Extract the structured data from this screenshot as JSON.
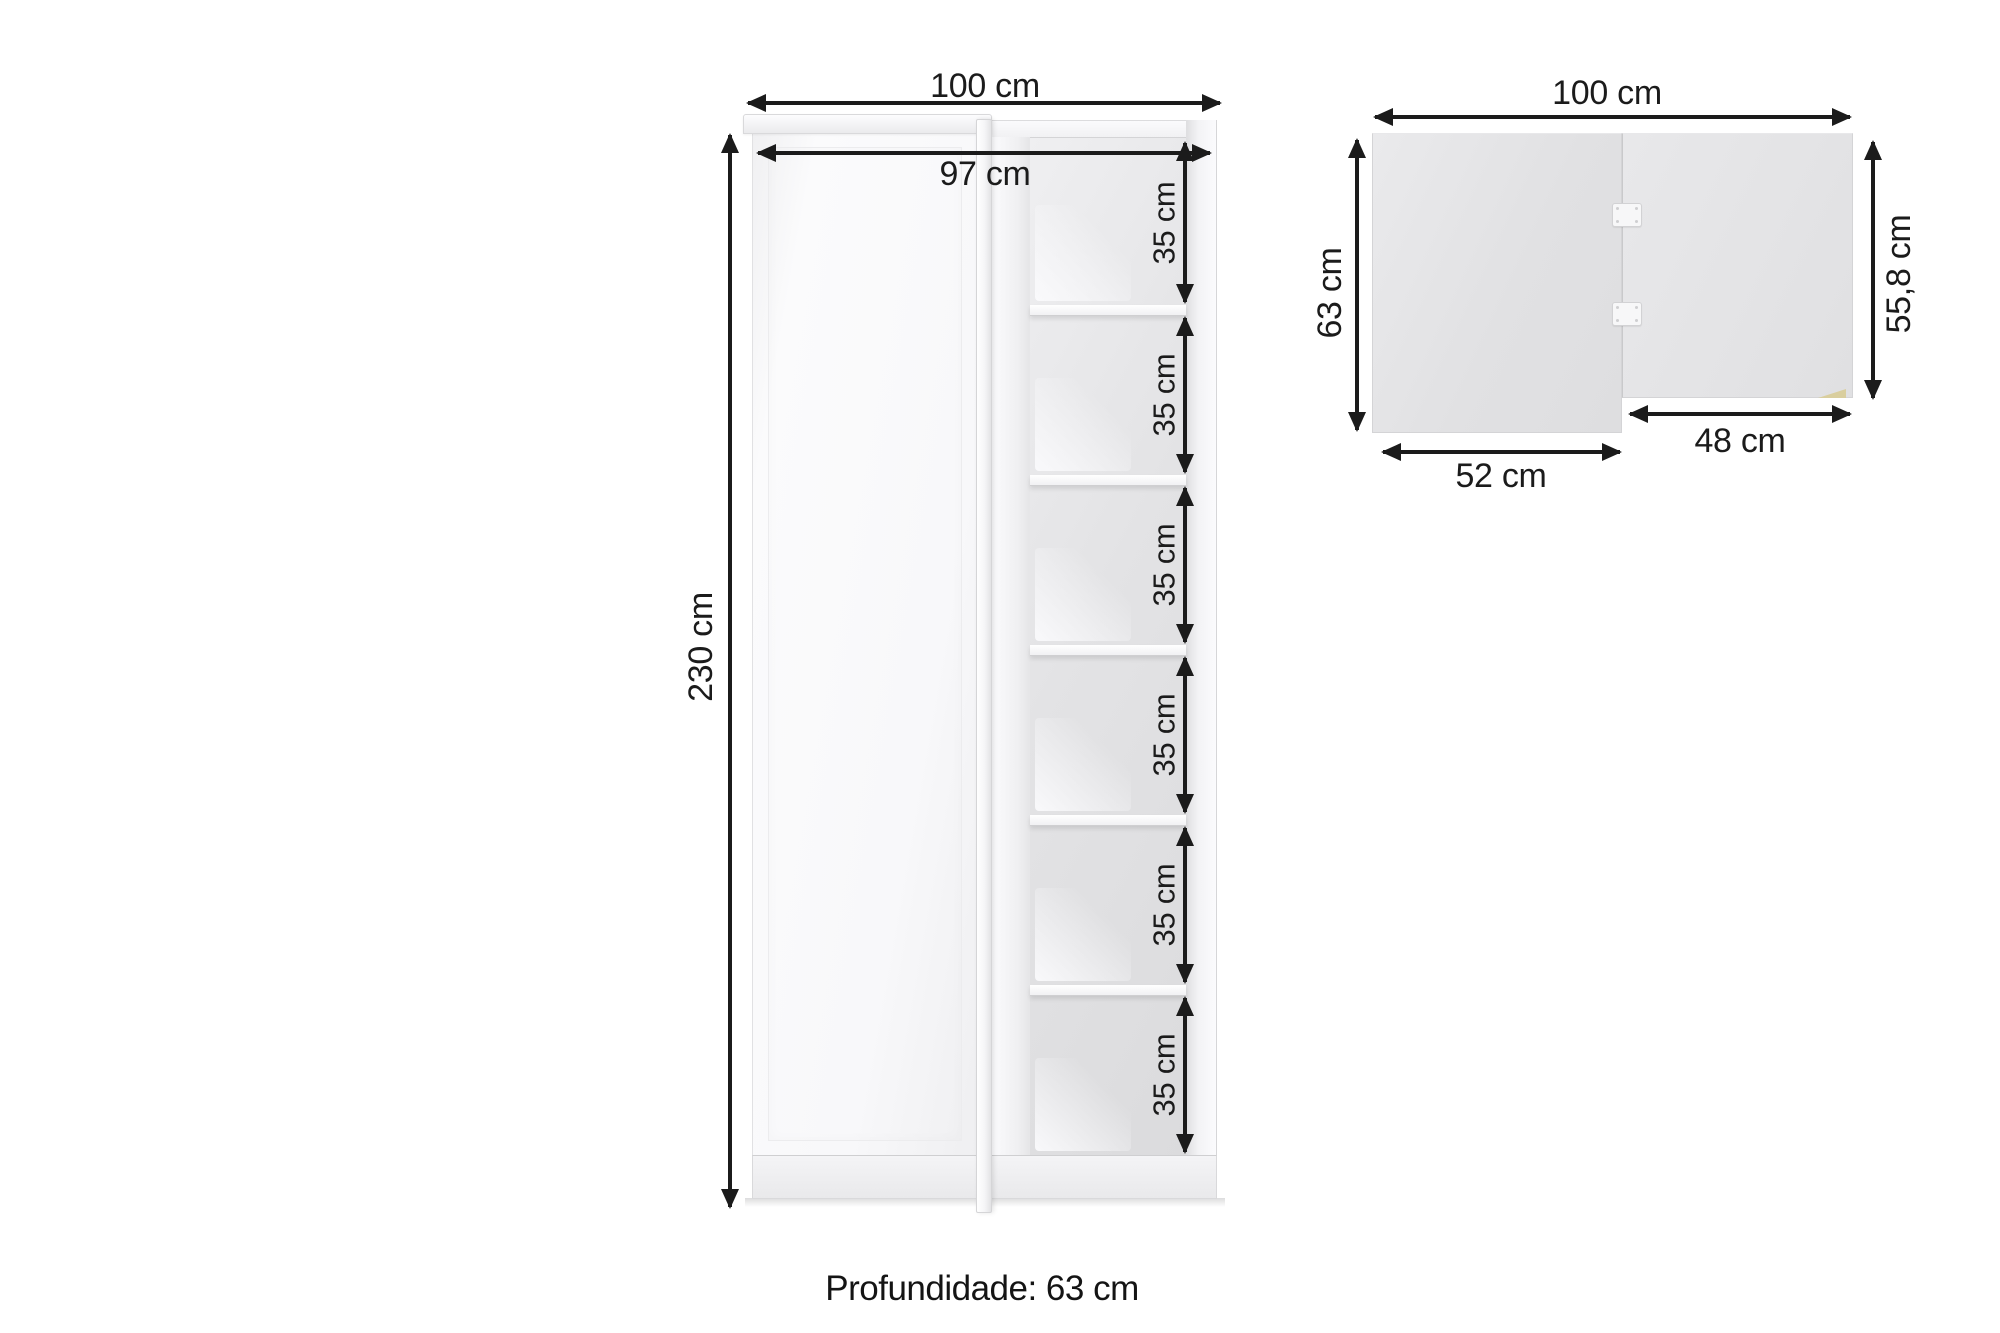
{
  "front_view": {
    "width_label": "100 cm",
    "inner_width_label": "97 cm",
    "height_label": "230 cm",
    "compartments": [
      {
        "label": "35 cm"
      },
      {
        "label": "35 cm"
      },
      {
        "label": "35 cm"
      },
      {
        "label": "35 cm"
      },
      {
        "label": "35 cm"
      },
      {
        "label": "35 cm"
      }
    ]
  },
  "top_view": {
    "width_label": "100 cm",
    "left_depth_label": "63 cm",
    "right_depth_label": "55,8 cm",
    "right_section_width_label": "48 cm",
    "left_section_width_label": "52 cm"
  },
  "footer": {
    "depth_note": "Profundidade: 63 cm"
  },
  "colors": {
    "dimension_ink": "#1b1b1b",
    "panel_white": "#fafafb",
    "interior_gray": "#e2e2e4",
    "edge_gray": "#d4d4d6",
    "wood_accent": "#d9ce9e",
    "background": "#ffffff"
  }
}
